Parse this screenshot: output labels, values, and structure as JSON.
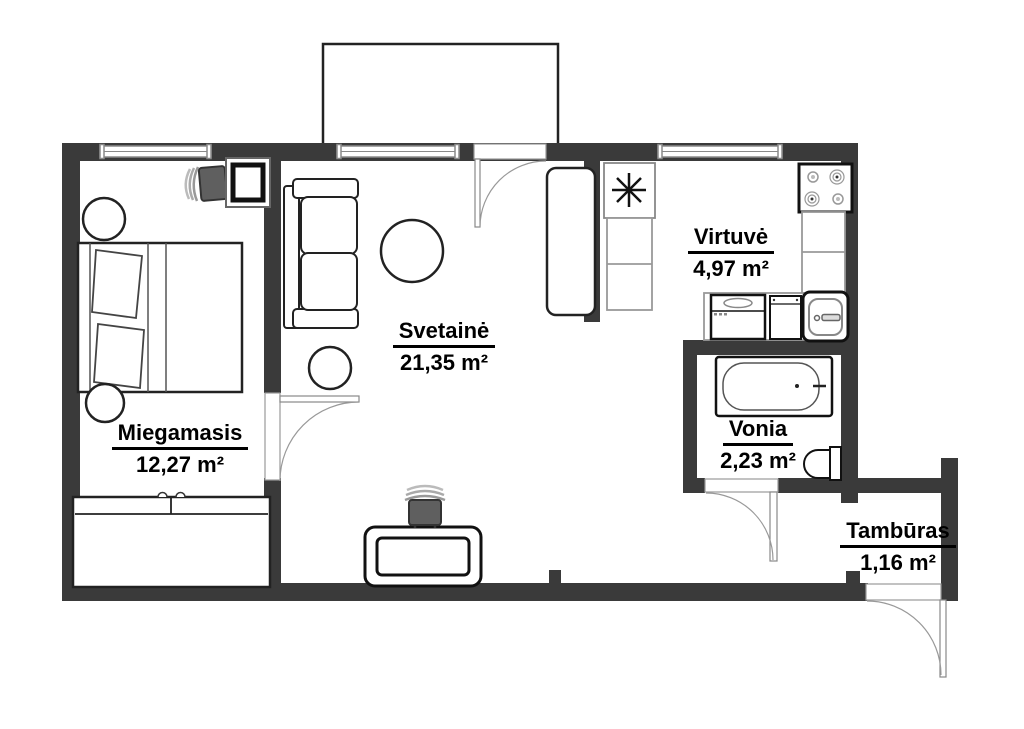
{
  "plan": {
    "rooms": [
      {
        "id": "bedroom",
        "name": "Miegamasis",
        "area": "12,27 m²"
      },
      {
        "id": "living",
        "name": "Svetainė",
        "area": "21,35 m²"
      },
      {
        "id": "kitchen",
        "name": "Virtuvė",
        "area": "4,97 m²"
      },
      {
        "id": "bathroom",
        "name": "Vonia",
        "area": "2,23 m²"
      },
      {
        "id": "vestibule",
        "name": "Tambūras",
        "area": "1,16 m²"
      }
    ],
    "colors": {
      "wall": "#3a3a3a",
      "outline": "#1f1f1f",
      "frame": "#999999",
      "background": "#ffffff"
    }
  }
}
